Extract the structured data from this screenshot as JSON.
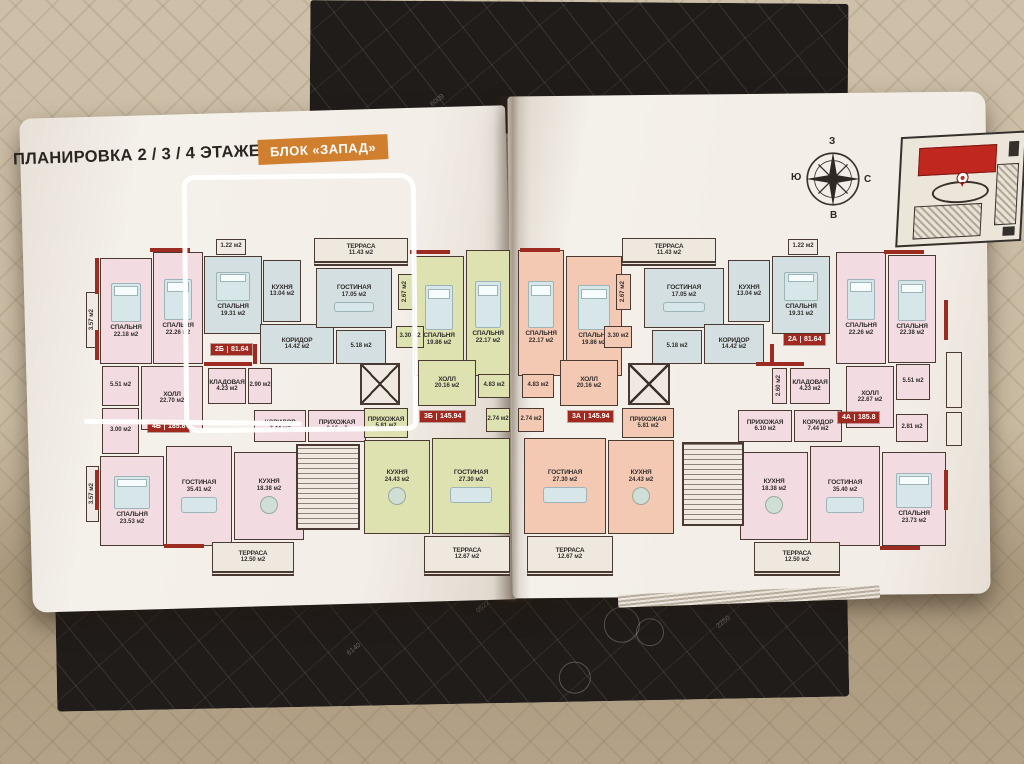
{
  "header": {
    "title": "ПЛАНИРОВКА 2 / 3 / 4 ЭТАЖЕЙ",
    "block_badge": "БЛОК «ЗАПАД»",
    "badge_color": "#cf7f2e"
  },
  "compass": {
    "top": "З",
    "left": "Ю",
    "right": "С",
    "bottom": "В"
  },
  "cover_markings": [
    "6009",
    "0522",
    "6140",
    "2250"
  ],
  "plan": {
    "unit": "м2",
    "colors": {
      "wall": "#4a3a31",
      "red_accent": "#9c2b21",
      "badge_red": "#a02a20",
      "pink": "#f3dbe2",
      "blue": "#d4dfe2",
      "green": "#dde2b0",
      "salmon": "#f3c9b4",
      "neutral": "#f0eae2",
      "terrace": "#efe8df"
    },
    "apartments": [
      {
        "id": "2Б",
        "total_area": "81.64",
        "color": "blue"
      },
      {
        "id": "3Б",
        "total_area": "145.94",
        "color": "green"
      },
      {
        "id": "4Б",
        "total_area": "185.8",
        "color": "pink"
      },
      {
        "id": "3А",
        "total_area": "145.94",
        "color": "salmon"
      },
      {
        "id": "2А",
        "total_area": "81.64",
        "color": "blue"
      },
      {
        "id": "4А",
        "total_area": "185.8",
        "color": "pink"
      }
    ],
    "badges": [
      {
        "id": "2Б",
        "area": "81.64",
        "x": 211,
        "y": 344
      },
      {
        "id": "4Б",
        "area": "185.8",
        "x": 148,
        "y": 421
      },
      {
        "id": "3Б",
        "area": "145.94",
        "x": 420,
        "y": 411
      },
      {
        "id": "3А",
        "area": "145.94",
        "x": 568,
        "y": 411
      },
      {
        "id": "2А",
        "area": "81.64",
        "x": 784,
        "y": 334
      },
      {
        "id": "4А",
        "area": "185.8",
        "x": 838,
        "y": 412
      }
    ],
    "rooms": [
      {
        "n": "СПАЛЬНЯ",
        "a": "22.18 м2",
        "x": 100,
        "y": 258,
        "w": 52,
        "h": 106,
        "c": "pink",
        "f": "bed"
      },
      {
        "n": "СПАЛЬНЯ",
        "a": "22.26 м2",
        "x": 153,
        "y": 252,
        "w": 50,
        "h": 112,
        "c": "pink",
        "f": "bed"
      },
      {
        "n": "СПАЛЬНЯ",
        "a": "19.31 м2",
        "x": 204,
        "y": 256,
        "w": 58,
        "h": 78,
        "c": "blue",
        "f": "bed"
      },
      {
        "n": "",
        "a": "1.22 м2",
        "x": 216,
        "y": 239,
        "w": 30,
        "h": 16,
        "c": "neutral"
      },
      {
        "n": "КУХНЯ",
        "a": "13.04 м2",
        "x": 263,
        "y": 260,
        "w": 38,
        "h": 62,
        "c": "blue"
      },
      {
        "n": "КОРИДОР",
        "a": "14.42 м2",
        "x": 260,
        "y": 324,
        "w": 74,
        "h": 40,
        "c": "blue"
      },
      {
        "n": "ТЕРРАСА",
        "a": "11.43 м2",
        "x": 314,
        "y": 238,
        "w": 94,
        "h": 28,
        "c": "terrace"
      },
      {
        "n": "ГОСТИНАЯ",
        "a": "17.05 м2",
        "x": 316,
        "y": 268,
        "w": 76,
        "h": 60,
        "c": "blue",
        "f": "sofa"
      },
      {
        "n": "",
        "a": "5.18 м2",
        "x": 336,
        "y": 330,
        "w": 50,
        "h": 34,
        "c": "blue"
      },
      {
        "n": "ХОЛЛ",
        "a": "22.70 м2",
        "x": 141,
        "y": 366,
        "w": 62,
        "h": 64,
        "c": "pink"
      },
      {
        "n": "",
        "a": "5.51 м2",
        "x": 102,
        "y": 366,
        "w": 37,
        "h": 40,
        "c": "pink"
      },
      {
        "n": "",
        "a": "3.00 м2",
        "x": 102,
        "y": 408,
        "w": 37,
        "h": 46,
        "c": "pink"
      },
      {
        "n": "КЛАДОВАЯ",
        "a": "4.23 м2",
        "x": 208,
        "y": 368,
        "w": 38,
        "h": 36,
        "c": "pink"
      },
      {
        "n": "",
        "a": "2.90 м2",
        "x": 248,
        "y": 368,
        "w": 24,
        "h": 36,
        "c": "pink"
      },
      {
        "n": "КОРИДОР",
        "a": "7.44 м2",
        "x": 254,
        "y": 410,
        "w": 52,
        "h": 32,
        "c": "pink"
      },
      {
        "n": "ПРИХОЖАЯ",
        "a": "6.10 м2",
        "x": 308,
        "y": 410,
        "w": 58,
        "h": 32,
        "c": "pink"
      },
      {
        "n": "СПАЛЬНЯ",
        "a": "23.53 м2",
        "x": 100,
        "y": 456,
        "w": 64,
        "h": 90,
        "c": "pink",
        "f": "bed"
      },
      {
        "n": "ГОСТИНАЯ",
        "a": "35.41 м2",
        "x": 166,
        "y": 446,
        "w": 66,
        "h": 100,
        "c": "pink",
        "f": "sofa"
      },
      {
        "n": "КУХНЯ",
        "a": "18.38 м2",
        "x": 234,
        "y": 452,
        "w": 70,
        "h": 88,
        "c": "pink",
        "f": "table"
      },
      {
        "n": "ТЕРРАСА",
        "a": "12.50 м2",
        "x": 212,
        "y": 542,
        "w": 82,
        "h": 34,
        "c": "terrace"
      },
      {
        "n": "ПРИХОЖАЯ",
        "a": "5.81 м2",
        "x": 364,
        "y": 408,
        "w": 44,
        "h": 30,
        "c": "green"
      },
      {
        "n": "СПАЛЬНЯ",
        "a": "19.86 м2",
        "x": 414,
        "y": 256,
        "w": 50,
        "h": 120,
        "c": "green",
        "f": "bed"
      },
      {
        "n": "СПАЛЬНЯ",
        "a": "22.17 м2",
        "x": 466,
        "y": 250,
        "w": 44,
        "h": 126,
        "c": "green",
        "f": "bed"
      },
      {
        "n": "",
        "a": "2.67 м2",
        "x": 398,
        "y": 274,
        "w": 15,
        "h": 36,
        "c": "green",
        "v": true
      },
      {
        "n": "",
        "a": "3.30 м2",
        "x": 396,
        "y": 326,
        "w": 28,
        "h": 22,
        "c": "green"
      },
      {
        "n": "ХОЛЛ",
        "a": "20.16 м2",
        "x": 418,
        "y": 360,
        "w": 58,
        "h": 46,
        "c": "green"
      },
      {
        "n": "",
        "a": "4.83 м2",
        "x": 478,
        "y": 374,
        "w": 32,
        "h": 24,
        "c": "green"
      },
      {
        "n": "КУХНЯ",
        "a": "24.43 м2",
        "x": 364,
        "y": 440,
        "w": 66,
        "h": 94,
        "c": "green",
        "f": "table"
      },
      {
        "n": "ГОСТИНАЯ",
        "a": "27.30 м2",
        "x": 432,
        "y": 438,
        "w": 78,
        "h": 96,
        "c": "green",
        "f": "sofa"
      },
      {
        "n": "",
        "a": "2.74 м2",
        "x": 486,
        "y": 408,
        "w": 24,
        "h": 24,
        "c": "green"
      },
      {
        "n": "ТЕРРАСА",
        "a": "12.67 м2",
        "x": 424,
        "y": 536,
        "w": 86,
        "h": 40,
        "c": "terrace"
      },
      {
        "n": "",
        "a": "",
        "x": 360,
        "y": 363,
        "w": 40,
        "h": 42,
        "c": "elevator"
      },
      {
        "n": "",
        "a": "",
        "x": 296,
        "y": 444,
        "w": 64,
        "h": 86,
        "c": "stairs"
      },
      {
        "n": "",
        "a": "3.57 м2",
        "x": 86,
        "y": 292,
        "w": 13,
        "h": 56,
        "c": "neutral",
        "v": true
      },
      {
        "n": "",
        "a": "3.57 м2",
        "x": 86,
        "y": 466,
        "w": 13,
        "h": 56,
        "c": "neutral",
        "v": true
      },
      {
        "n": "СПАЛЬНЯ",
        "a": "22.17 м2",
        "x": 518,
        "y": 250,
        "w": 46,
        "h": 126,
        "c": "salmon",
        "f": "bed"
      },
      {
        "n": "СПАЛЬНЯ",
        "a": "19.86 м2",
        "x": 566,
        "y": 256,
        "w": 56,
        "h": 120,
        "c": "salmon",
        "f": "bed"
      },
      {
        "n": "",
        "a": "2.67 м2",
        "x": 616,
        "y": 274,
        "w": 15,
        "h": 36,
        "c": "salmon",
        "v": true
      },
      {
        "n": "",
        "a": "3.30 м2",
        "x": 604,
        "y": 326,
        "w": 28,
        "h": 22,
        "c": "salmon"
      },
      {
        "n": "ХОЛЛ",
        "a": "20.16 м2",
        "x": 560,
        "y": 360,
        "w": 58,
        "h": 46,
        "c": "salmon"
      },
      {
        "n": "",
        "a": "4.83 м2",
        "x": 522,
        "y": 374,
        "w": 32,
        "h": 24,
        "c": "salmon"
      },
      {
        "n": "",
        "a": "2.74 м2",
        "x": 518,
        "y": 408,
        "w": 26,
        "h": 24,
        "c": "salmon"
      },
      {
        "n": "ПРИХОЖАЯ",
        "a": "5.81 м2",
        "x": 622,
        "y": 408,
        "w": 52,
        "h": 30,
        "c": "salmon"
      },
      {
        "n": "ГОСТИНАЯ",
        "a": "27.30 м2",
        "x": 524,
        "y": 438,
        "w": 82,
        "h": 96,
        "c": "salmon",
        "f": "sofa"
      },
      {
        "n": "КУХНЯ",
        "a": "24.43 м2",
        "x": 608,
        "y": 440,
        "w": 66,
        "h": 94,
        "c": "salmon",
        "f": "table"
      },
      {
        "n": "ТЕРРАСА",
        "a": "12.67 м2",
        "x": 527,
        "y": 536,
        "w": 86,
        "h": 40,
        "c": "terrace"
      },
      {
        "n": "ТЕРРАСА",
        "a": "11.43 м2",
        "x": 622,
        "y": 238,
        "w": 94,
        "h": 28,
        "c": "terrace"
      },
      {
        "n": "ГОСТИНАЯ",
        "a": "17.05 м2",
        "x": 644,
        "y": 268,
        "w": 80,
        "h": 60,
        "c": "blue",
        "f": "sofa"
      },
      {
        "n": "",
        "a": "5.18 м2",
        "x": 652,
        "y": 330,
        "w": 50,
        "h": 34,
        "c": "blue"
      },
      {
        "n": "КОРИДОР",
        "a": "14.42 м2",
        "x": 704,
        "y": 324,
        "w": 60,
        "h": 40,
        "c": "blue"
      },
      {
        "n": "КУХНЯ",
        "a": "13.04 м2",
        "x": 728,
        "y": 260,
        "w": 42,
        "h": 62,
        "c": "blue"
      },
      {
        "n": "СПАЛЬНЯ",
        "a": "19.31 м2",
        "x": 772,
        "y": 256,
        "w": 58,
        "h": 78,
        "c": "blue",
        "f": "bed"
      },
      {
        "n": "",
        "a": "1.22 м2",
        "x": 788,
        "y": 239,
        "w": 30,
        "h": 16,
        "c": "neutral"
      },
      {
        "n": "КЛАДОВАЯ",
        "a": "4.23 м2",
        "x": 790,
        "y": 368,
        "w": 40,
        "h": 36,
        "c": "pink"
      },
      {
        "n": "",
        "a": "2.60 м2",
        "x": 772,
        "y": 368,
        "w": 15,
        "h": 36,
        "c": "pink",
        "v": true
      },
      {
        "n": "ХОЛЛ",
        "a": "22.67 м2",
        "x": 846,
        "y": 366,
        "w": 48,
        "h": 62,
        "c": "pink"
      },
      {
        "n": "",
        "a": "5.51 м2",
        "x": 896,
        "y": 364,
        "w": 34,
        "h": 36,
        "c": "pink"
      },
      {
        "n": "",
        "a": "2.81 м2",
        "x": 896,
        "y": 414,
        "w": 32,
        "h": 28,
        "c": "pink"
      },
      {
        "n": "ПРИХОЖАЯ",
        "a": "6.10 м2",
        "x": 738,
        "y": 410,
        "w": 54,
        "h": 32,
        "c": "pink"
      },
      {
        "n": "КОРИДОР",
        "a": "7.44 м2",
        "x": 794,
        "y": 410,
        "w": 48,
        "h": 32,
        "c": "pink"
      },
      {
        "n": "КУХНЯ",
        "a": "18.38 м2",
        "x": 740,
        "y": 452,
        "w": 68,
        "h": 88,
        "c": "pink",
        "f": "table"
      },
      {
        "n": "ГОСТИНАЯ",
        "a": "35.40 м2",
        "x": 810,
        "y": 446,
        "w": 70,
        "h": 100,
        "c": "pink",
        "f": "sofa"
      },
      {
        "n": "СПАЛЬНЯ",
        "a": "23.73 м2",
        "x": 882,
        "y": 452,
        "w": 64,
        "h": 94,
        "c": "pink",
        "f": "bed"
      },
      {
        "n": "ТЕРРАСА",
        "a": "12.50 м2",
        "x": 754,
        "y": 542,
        "w": 86,
        "h": 34,
        "c": "terrace"
      },
      {
        "n": "СПАЛЬНЯ",
        "a": "22.26 м2",
        "x": 836,
        "y": 252,
        "w": 50,
        "h": 112,
        "c": "pink",
        "f": "bed"
      },
      {
        "n": "СПАЛЬНЯ",
        "a": "22.38 м2",
        "x": 888,
        "y": 255,
        "w": 48,
        "h": 108,
        "c": "pink",
        "f": "bed"
      },
      {
        "n": "",
        "a": "",
        "x": 628,
        "y": 363,
        "w": 42,
        "h": 42,
        "c": "elevator"
      },
      {
        "n": "",
        "a": "",
        "x": 682,
        "y": 442,
        "w": 62,
        "h": 84,
        "c": "stairs"
      },
      {
        "n": "",
        "a": "",
        "x": 946,
        "y": 352,
        "w": 16,
        "h": 56,
        "c": "neutral"
      },
      {
        "n": "",
        "a": "",
        "x": 946,
        "y": 412,
        "w": 16,
        "h": 34,
        "c": "neutral"
      }
    ]
  }
}
